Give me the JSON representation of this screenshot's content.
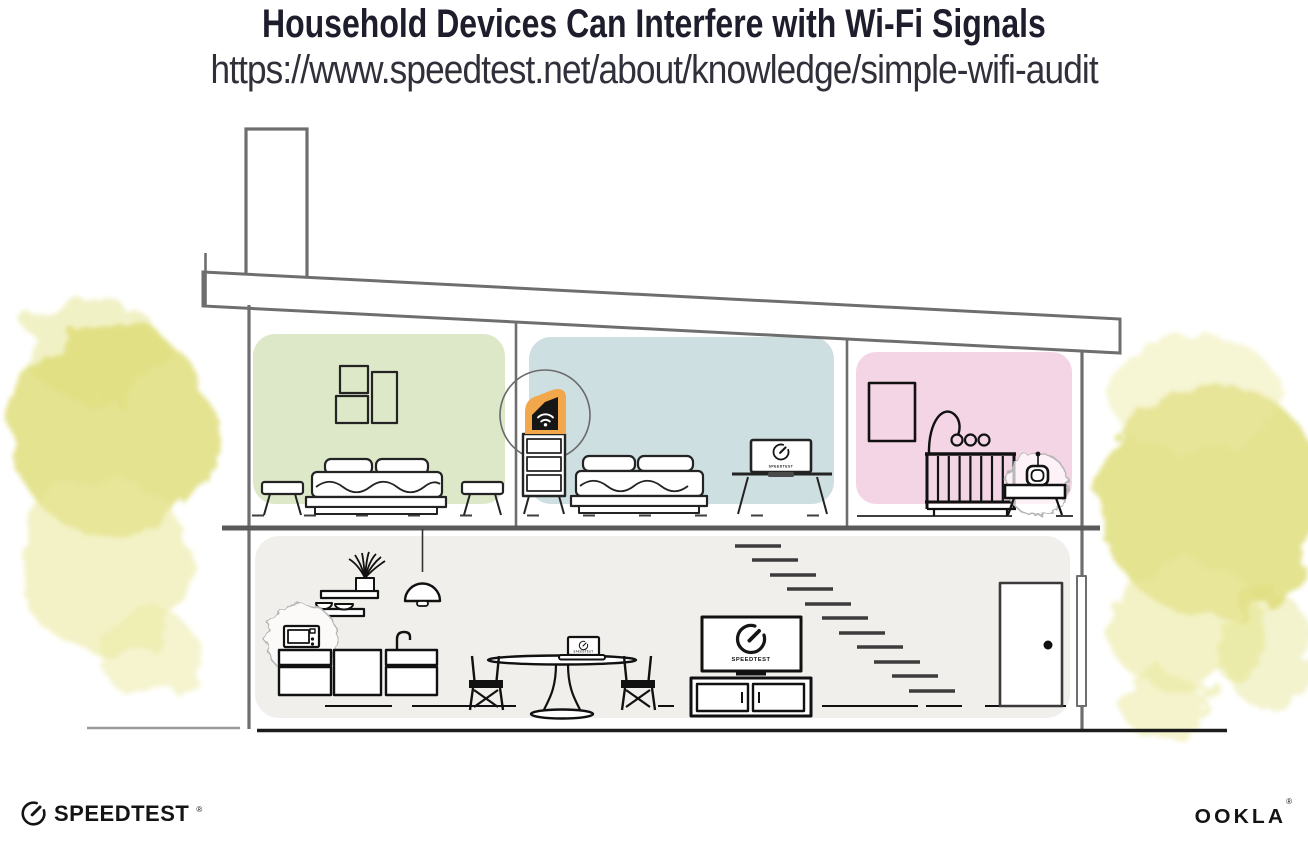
{
  "header": {
    "title": "Household Devices Can Interfere with Wi-Fi Signals",
    "url": "https://www.speedtest.net/about/knowledge/simple-wifi-audit"
  },
  "branding": {
    "speedtest_wordmark": "SPEEDTEST",
    "speedtest_trademark": "®",
    "ookla_wordmark": "OOKLA",
    "ookla_trademark": "®"
  },
  "illustration": {
    "tv_screen_label": "SPEEDTEST",
    "bedroom_laptop_label": "SPEEDTEST",
    "dining_laptop_label": "SPEEDTEST",
    "icons": {
      "wifi_icon": "wifi arcs on router",
      "speedtest_gauge_icon": "circular gauge with needle"
    }
  },
  "colors": {
    "title_ink": "#1d1d2c",
    "line_gray": "#6e6e6e",
    "floor_gray": "#5a5a5a",
    "room_green": "#dde8c9",
    "room_blue": "#cedfe1",
    "room_pink": "#f4d5e5",
    "room_gray": "#f0efec",
    "router_orange": "#f2a74b",
    "tree_yellow": "#dddc74",
    "tree_yellow_light": "#ebe9a0",
    "burst_gray": "#b5b5b5"
  }
}
